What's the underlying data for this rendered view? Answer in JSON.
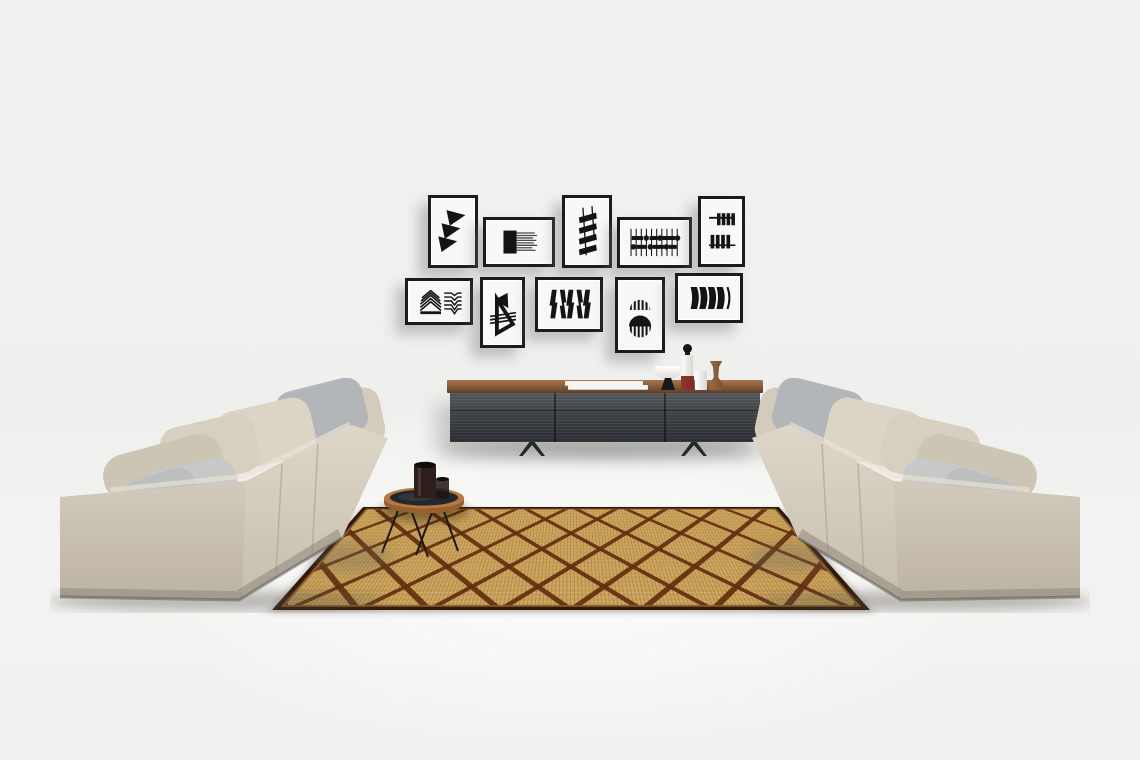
{
  "scene": {
    "type": "interior-photograph",
    "description": "Minimalist living room: two beige fabric sofas facing each other across a straw rug with brown diamond lattice, a walnut-topped charcoal sideboard against the wall, a gallery wall of ten black-and-white graphic prints, and a round tray coffee table with dark vases."
  },
  "palette": {
    "wall": "#f1f1ef",
    "print-paper": "#f8f8f6",
    "frame-border": "#1b1b1b",
    "art-ink": "#141414",
    "sideboard-top": "#8a5f3c",
    "sideboard-body": "#41464b",
    "sideboard-body-dark": "#2c3034",
    "rug-base": "#c9a158",
    "rug-lattice": "#622e0e",
    "rug-border": "#2e1a0a",
    "sofa-fabric": "#d6cfc0",
    "sofa-fabric-shade": "#c2bAA9",
    "pillow-gray": "#b2b6b8",
    "pillow-light-gray": "#c6c9c7",
    "table-rim": "#b5793f",
    "table-top": "#23272b",
    "vessel-brown": "#2f1f1c",
    "bottle-red": "#7e2b26",
    "wood-accent": "#8a5a36"
  },
  "gallery": {
    "frame_count": 10,
    "rows": 2,
    "frames": [
      {
        "id": "frame-1",
        "orientation": "portrait",
        "motif": "stacked pennant triangles"
      },
      {
        "id": "frame-2",
        "orientation": "landscape",
        "motif": "ink block with bristle lines"
      },
      {
        "id": "frame-3",
        "orientation": "portrait",
        "motif": "slanted ladder bars"
      },
      {
        "id": "frame-4",
        "orientation": "landscape",
        "motif": "abacus grid of bars and dots"
      },
      {
        "id": "frame-5",
        "orientation": "portrait",
        "motif": "hanging bar combs"
      },
      {
        "id": "frame-6",
        "orientation": "landscape",
        "motif": "chevron stack and kinked lines"
      },
      {
        "id": "frame-7",
        "orientation": "portrait",
        "motif": "diagonal sail forms"
      },
      {
        "id": "frame-8",
        "orientation": "landscape",
        "motif": "kinked vertical bars"
      },
      {
        "id": "frame-9",
        "orientation": "portrait",
        "motif": "striped dome and eclipse circle"
      },
      {
        "id": "frame-10",
        "orientation": "landscape",
        "motif": "bold curved blades"
      }
    ]
  },
  "furniture": {
    "sofa_left": {
      "label": "Beige fabric sofa (left)",
      "pillows": 7,
      "gray_pillows": 3
    },
    "sofa_right": {
      "label": "Beige fabric sofa (right)",
      "pillows": 7,
      "gray_pillows": 3
    },
    "sideboard": {
      "label": "Walnut-top charcoal sideboard on sled legs",
      "doors": 3,
      "decor": [
        "stack of white books",
        "white pedestal bowl on black base",
        "white bottle with black stopper and red band",
        "white cylinder vase",
        "turned walnut vessel"
      ]
    },
    "coffee_table": {
      "label": "Round wood-rim tray table with black top",
      "items": [
        "dark brown vase",
        "small dark glass"
      ]
    },
    "rug": {
      "label": "Woven straw rug",
      "pattern": "brown diamond lattice"
    }
  }
}
